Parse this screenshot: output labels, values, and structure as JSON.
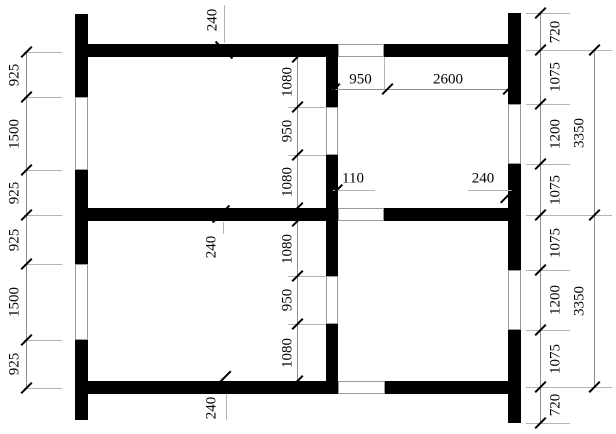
{
  "drawing_title": "wall-plan-with-dimensions",
  "canvas": {
    "w": 616,
    "h": 434,
    "bg": "#ffffff",
    "wall_color": "#000000",
    "line_color": "#8f8f8f",
    "connector_color": "#b5b5b5",
    "opening_border": "#9a9a9a",
    "tick_color": "#000000",
    "font_px": 15
  },
  "walls": [
    {
      "x": 75,
      "y": 14,
      "w": 13,
      "h": 83
    },
    {
      "x": 75,
      "y": 170,
      "w": 13,
      "h": 94
    },
    {
      "x": 75,
      "y": 340,
      "w": 13,
      "h": 80
    },
    {
      "x": 508,
      "y": 13,
      "w": 13,
      "h": 91
    },
    {
      "x": 508,
      "y": 164,
      "w": 13,
      "h": 106
    },
    {
      "x": 508,
      "y": 330,
      "w": 13,
      "h": 93
    },
    {
      "x": 88,
      "y": 44,
      "w": 250,
      "h": 13
    },
    {
      "x": 384,
      "y": 44,
      "w": 128,
      "h": 13
    },
    {
      "x": 88,
      "y": 208,
      "w": 250,
      "h": 13
    },
    {
      "x": 384,
      "y": 208,
      "w": 128,
      "h": 13
    },
    {
      "x": 88,
      "y": 381,
      "w": 250,
      "h": 13
    },
    {
      "x": 385,
      "y": 381,
      "w": 127,
      "h": 13
    },
    {
      "x": 326,
      "y": 50,
      "w": 12,
      "h": 57
    },
    {
      "x": 326,
      "y": 155,
      "w": 12,
      "h": 121
    },
    {
      "x": 326,
      "y": 324,
      "w": 12,
      "h": 62
    }
  ],
  "openings": [
    {
      "x": 75,
      "y": 97,
      "w": 13,
      "h": 73
    },
    {
      "x": 75,
      "y": 264,
      "w": 13,
      "h": 76
    },
    {
      "x": 508,
      "y": 104,
      "w": 13,
      "h": 60
    },
    {
      "x": 508,
      "y": 270,
      "w": 13,
      "h": 60
    },
    {
      "x": 326,
      "y": 107,
      "w": 12,
      "h": 48
    },
    {
      "x": 326,
      "y": 276,
      "w": 12,
      "h": 48
    },
    {
      "x": 338,
      "y": 44,
      "w": 46,
      "h": 13
    },
    {
      "x": 338,
      "y": 208,
      "w": 46,
      "h": 13
    },
    {
      "x": 338,
      "y": 381,
      "w": 47,
      "h": 13
    }
  ],
  "chains": [
    {
      "name": "left-outer-chain",
      "orientation": "vertical",
      "line_pos": 26,
      "from": 52,
      "to": 388,
      "ticks": [
        52,
        97,
        170,
        215,
        264,
        340,
        388
      ],
      "connectors": {
        "at": [
          52,
          97,
          170,
          215,
          264,
          340,
          388
        ],
        "a": 24,
        "b": 62
      },
      "label_pos": 15,
      "rotated": true,
      "segments": [
        {
          "value": "925",
          "mid": 74.5
        },
        {
          "value": "1500",
          "mid": 133.5
        },
        {
          "value": "925",
          "mid": 192.5
        },
        {
          "value": "925",
          "mid": 239.5
        },
        {
          "value": "1500",
          "mid": 302
        },
        {
          "value": "925",
          "mid": 364
        }
      ]
    },
    {
      "name": "right-inner-chain",
      "orientation": "vertical",
      "line_pos": 540,
      "from": 13,
      "to": 423,
      "ticks": [
        13,
        50,
        104,
        164,
        215,
        270,
        330,
        387,
        423
      ],
      "connectors": {
        "at": [
          13,
          104,
          164,
          270,
          330,
          423
        ],
        "a": 526,
        "b": 570
      },
      "connectors2": {
        "at": [
          50,
          215,
          387
        ],
        "a": 526,
        "b": 612
      },
      "label_pos": 556,
      "rotated": true,
      "segments": [
        {
          "value": "720",
          "mid": 31.5
        },
        {
          "value": "1075",
          "mid": 77
        },
        {
          "value": "1200",
          "mid": 134
        },
        {
          "value": "1075",
          "mid": 189.5
        },
        {
          "value": "1075",
          "mid": 242.5
        },
        {
          "value": "1200",
          "mid": 300
        },
        {
          "value": "1075",
          "mid": 358.5
        },
        {
          "value": "720",
          "mid": 405
        }
      ]
    },
    {
      "name": "right-outer-chain",
      "orientation": "vertical",
      "line_pos": 594,
      "from": 50,
      "to": 387,
      "ticks": [
        50,
        215,
        387
      ],
      "label_pos": 580,
      "rotated": true,
      "segments": [
        {
          "value": "3350",
          "mid": 133
        },
        {
          "value": "3350",
          "mid": 301
        }
      ]
    },
    {
      "name": "center-top-chain",
      "orientation": "vertical",
      "line_pos": 297,
      "from": 57,
      "to": 208,
      "ticks": [
        57,
        107,
        155,
        208
      ],
      "connectors": {
        "at": [
          107,
          155
        ],
        "a": 288,
        "b": 326
      },
      "label_pos": 288,
      "rotated": true,
      "segments": [
        {
          "value": "1080",
          "mid": 82
        },
        {
          "value": "950",
          "mid": 131
        },
        {
          "value": "1080",
          "mid": 181.5
        }
      ]
    },
    {
      "name": "center-bottom-chain",
      "orientation": "vertical",
      "line_pos": 297,
      "from": 221,
      "to": 381,
      "ticks": [
        221,
        276,
        324,
        381
      ],
      "connectors": {
        "at": [
          276,
          324
        ],
        "a": 288,
        "b": 326
      },
      "label_pos": 288,
      "rotated": true,
      "segments": [
        {
          "value": "1080",
          "mid": 248.5
        },
        {
          "value": "950",
          "mid": 300
        },
        {
          "value": "1080",
          "mid": 352.5
        }
      ]
    },
    {
      "name": "top-interior-horizontal",
      "orientation": "horizontal",
      "line_pos": 89,
      "from": 332,
      "to": 508,
      "ticks": [
        334,
        387,
        508
      ],
      "label_pos": 80,
      "rotated": false,
      "segments": [
        {
          "value": "950",
          "mid": 360.5
        },
        {
          "value": "2600",
          "mid": 448
        }
      ]
    }
  ],
  "extra_lines": [
    {
      "x": 384,
      "y": 57,
      "w": 1,
      "h": 32
    }
  ],
  "annotations": [
    {
      "value": "240",
      "rotated": true,
      "cx": 213,
      "cy": 20,
      "leader": {
        "x": 224,
        "y": 5,
        "w": 1,
        "h": 38
      },
      "tick": {
        "x": 224,
        "y": 50,
        "dir": "back",
        "len": 24
      }
    },
    {
      "value": "240",
      "rotated": true,
      "cx": 212,
      "cy": 247,
      "leader": {
        "x": 223,
        "y": 222,
        "w": 1,
        "h": 12
      },
      "tick": {
        "x": 221,
        "y": 214,
        "dir": "fwd",
        "len": 24
      }
    },
    {
      "value": "240",
      "rotated": true,
      "cx": 212,
      "cy": 408,
      "leader": {
        "x": 226,
        "y": 394,
        "w": 1,
        "h": 26
      },
      "tick": {
        "x": 223,
        "y": 379,
        "dir": "fwd",
        "len": 22
      }
    },
    {
      "value": "110",
      "rotated": false,
      "cx": 353,
      "cy": 179,
      "leader": {
        "x": 333,
        "y": 190,
        "w": 42,
        "h": 1
      },
      "tick": {
        "x": 336,
        "y": 191,
        "dir": "fwd",
        "len": 18
      }
    },
    {
      "value": "240",
      "rotated": false,
      "cx": 483,
      "cy": 179,
      "leader": {
        "x": 468,
        "y": 190,
        "w": 45,
        "h": 1
      },
      "tick": {
        "x": 509,
        "y": 194,
        "dir": "fwd",
        "len": 25
      }
    }
  ]
}
